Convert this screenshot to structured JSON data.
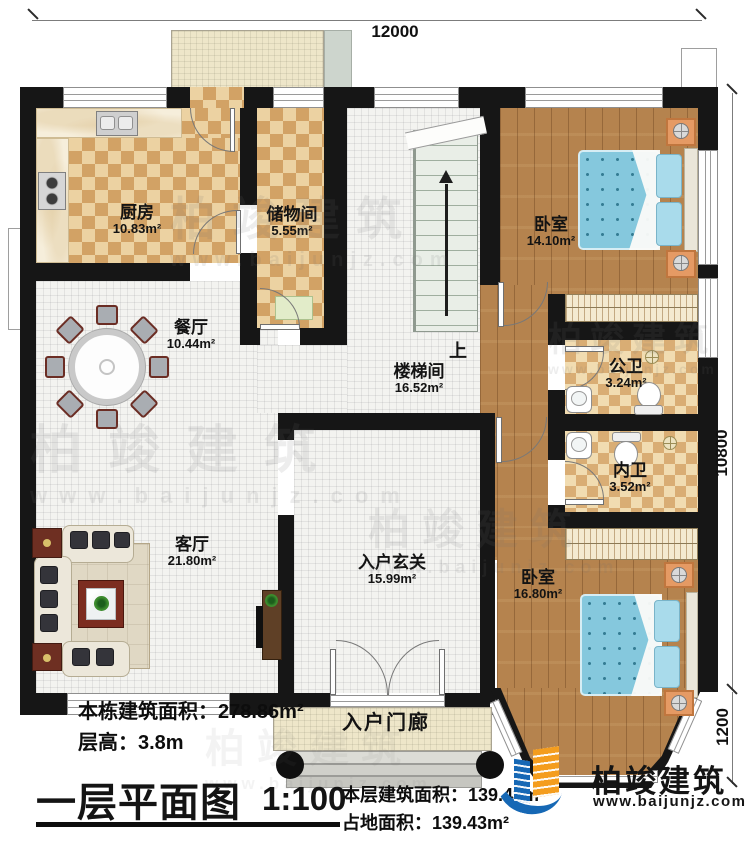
{
  "plan": {
    "dims": {
      "top": "12000",
      "right": "10800",
      "right_lower": "1200"
    },
    "stairs_up": "上",
    "rooms": [
      {
        "name": "厨房",
        "area": "10.83m²"
      },
      {
        "name": "储物间",
        "area": "5.55m²"
      },
      {
        "name": "餐厅",
        "area": "10.44m²"
      },
      {
        "name": "楼梯间",
        "area": "16.52m²"
      },
      {
        "name": "卧室",
        "area": "14.10m²"
      },
      {
        "name": "公卫",
        "area": "3.24m²"
      },
      {
        "name": "内卫",
        "area": "3.52m²"
      },
      {
        "name": "客厅",
        "area": "21.80m²"
      },
      {
        "name": "入户玄关",
        "area": "15.99m²"
      },
      {
        "name": "卧室",
        "area": "16.80m²"
      },
      {
        "name": "入户门廊",
        "area": ""
      }
    ],
    "info": {
      "building_area_label": "本栋建筑面积：",
      "building_area": "278.86m²",
      "floor_height_label": "层高：",
      "floor_height": "3.8m",
      "title": "一层平面图",
      "scale": "1:100",
      "floor_area_label": "本层建筑面积：",
      "floor_area": "139.43m²",
      "footprint_label": "占地面积：",
      "footprint": "139.43m²"
    },
    "brand": {
      "name": "柏竣建筑",
      "url": "www.baijunjz.com"
    },
    "watermark": {
      "name": "柏竣建筑",
      "url": "www.baijunjz.com"
    },
    "colors": {
      "brand_blue": "#1668b5",
      "brand_orange": "#f49d1e",
      "wall": "#161616"
    }
  }
}
